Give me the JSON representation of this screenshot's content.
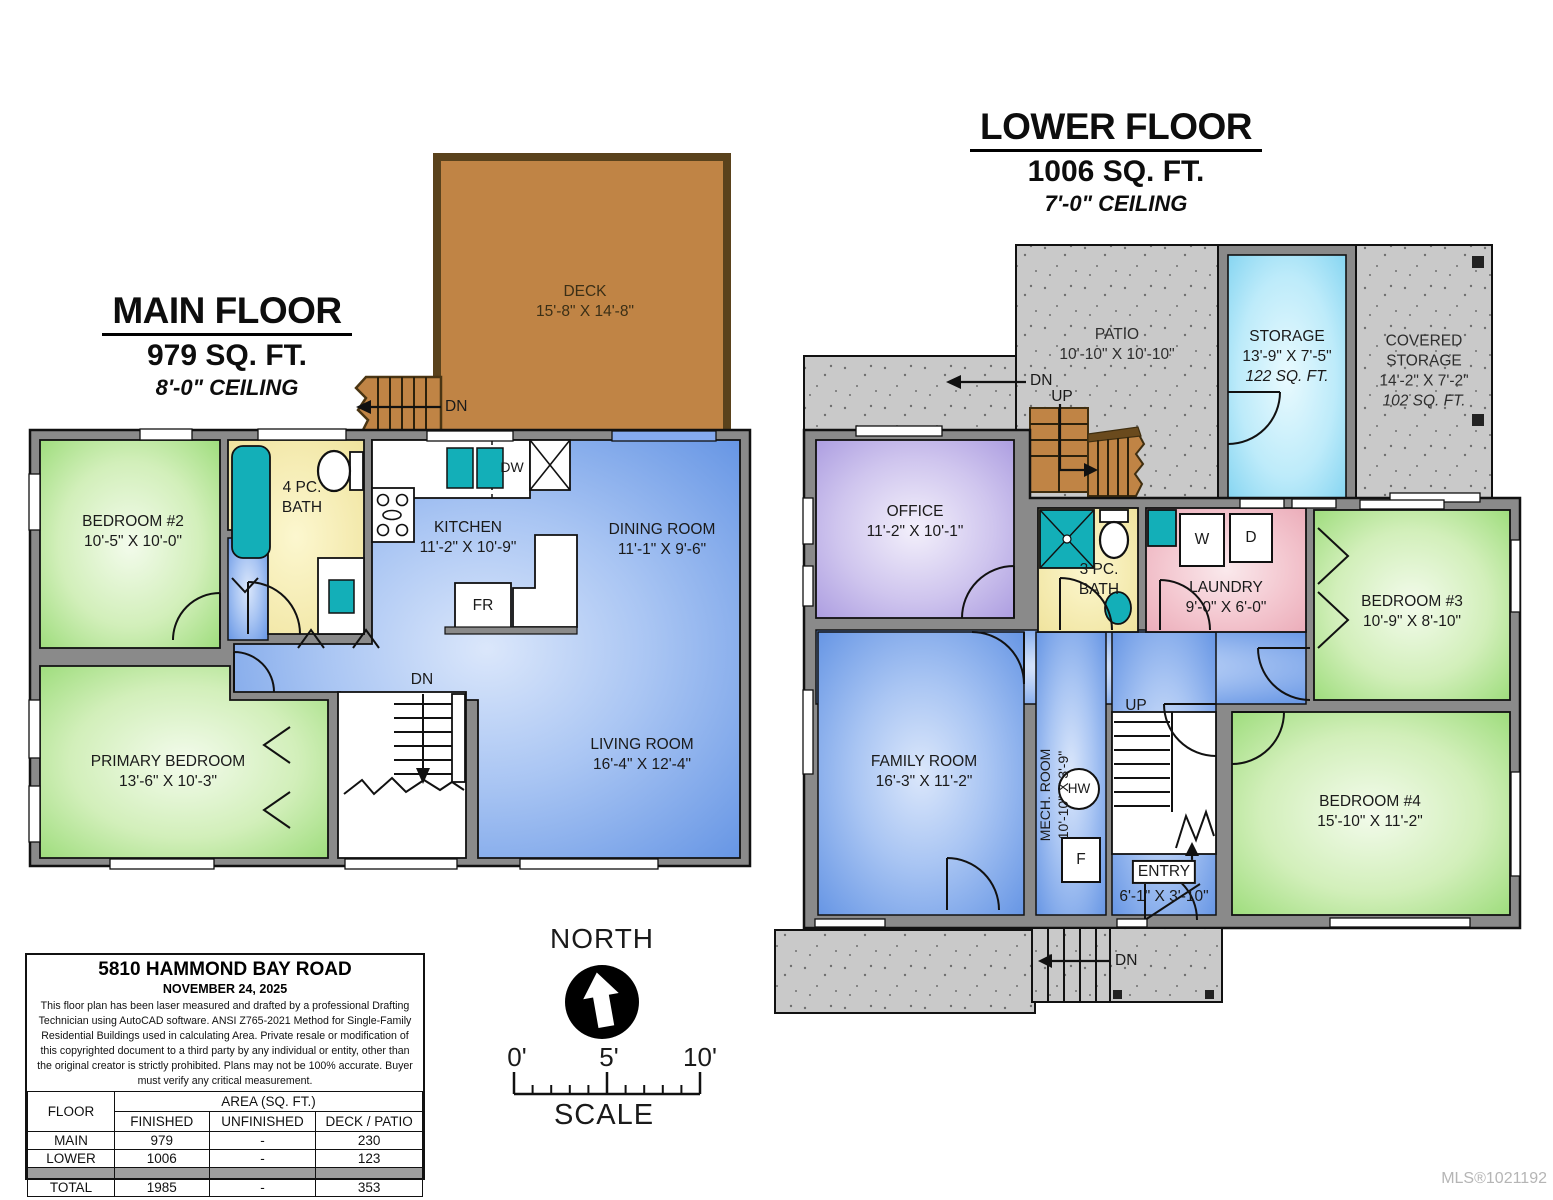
{
  "main_floor": {
    "title": "MAIN FLOOR",
    "area": "979 SQ. FT.",
    "ceiling": "8'-0\" CEILING",
    "deck": {
      "name": "DECK",
      "dims": "15'-8\" X 14'-8\""
    },
    "bedroom2": {
      "name": "BEDROOM #2",
      "dims": "10'-5\" X 10'-0\""
    },
    "bath": {
      "line1": "4 PC.",
      "line2": "BATH"
    },
    "kitchen": {
      "name": "KITCHEN",
      "dims": "11'-2\" X 10'-9\""
    },
    "dining": {
      "name": "DINING ROOM",
      "dims": "11'-1\" X 9'-6\""
    },
    "primary": {
      "name": "PRIMARY BEDROOM",
      "dims": "13'-6\" X 10'-3\""
    },
    "living": {
      "name": "LIVING ROOM",
      "dims": "16'-4\" X 12'-4\""
    },
    "labels": {
      "dn_deck": "DN",
      "dn_stairs": "DN",
      "dw": "DW",
      "fr": "FR"
    }
  },
  "lower_floor": {
    "title": "LOWER FLOOR",
    "area": "1006 SQ. FT.",
    "ceiling": "7'-0\" CEILING",
    "patio": {
      "name": "PATIO",
      "dims": "10'-10\" X 10'-10\""
    },
    "storage": {
      "name": "STORAGE",
      "dims": "13'-9\" X 7'-5\"",
      "sqft": "122 SQ. FT."
    },
    "covered_storage": {
      "name": "COVERED STORAGE",
      "dims": "14'-2\" X 7'-2\"",
      "sqft": "102 SQ. FT."
    },
    "office": {
      "name": "OFFICE",
      "dims": "11'-2\" X 10'-1\""
    },
    "bath": {
      "line1": "3 PC.",
      "line2": "BATH"
    },
    "laundry": {
      "name": "LAUNDRY",
      "dims": "9'-0\" X 6'-0\""
    },
    "bedroom3": {
      "name": "BEDROOM #3",
      "dims": "10'-9\" X 8'-10\""
    },
    "family": {
      "name": "FAMILY ROOM",
      "dims": "16'-3\" X 11'-2\""
    },
    "mech": {
      "name": "MECH. ROOM",
      "dims": "10'-10\" X 3'-9\""
    },
    "entry": {
      "name": "ENTRY",
      "dims": "6'-1\" X 3'-10\""
    },
    "bedroom4": {
      "name": "BEDROOM #4",
      "dims": "15'-10\" X 11'-2\""
    },
    "labels": {
      "dn_patio": "DN",
      "up_patio": "UP",
      "up_stairs": "UP",
      "dn_bottom": "DN",
      "hw": "HW",
      "f": "F",
      "w": "W",
      "d": "D"
    }
  },
  "compass": {
    "north": "NORTH",
    "scale": "SCALE",
    "tick0": "0'",
    "tick5": "5'",
    "tick10": "10'"
  },
  "info_box": {
    "address": "5810 HAMMOND BAY ROAD",
    "date": "NOVEMBER 24, 2025",
    "disclaimer": "This floor plan has been laser measured and drafted by a professional Drafting Technician using AutoCAD software. ANSI Z765-2021 Method for Single-Family Residential Buildings used in calculating Area. Private resale or modification of this copyrighted document to a third party by any individual or entity, other than the original creator is strictly prohibited. Plans may not be 100% accurate.  Buyer must verify any critical measurement.",
    "table": {
      "floor_header": "FLOOR",
      "area_header": "AREA (SQ. FT.)",
      "col_headers": [
        "FINISHED",
        "UNFINISHED",
        "DECK / PATIO"
      ],
      "rows": [
        {
          "floor": "MAIN",
          "finished": "979",
          "unfinished": "-",
          "deck_patio": "230"
        },
        {
          "floor": "LOWER",
          "finished": "1006",
          "unfinished": "-",
          "deck_patio": "123"
        },
        {
          "floor": "TOTAL",
          "finished": "1985",
          "unfinished": "-",
          "deck_patio": "353"
        }
      ]
    }
  },
  "watermark": "MLS®1021192",
  "colors": {
    "wall": "#8a8a8a",
    "room_blue": "#6494e4",
    "room_green": "#9cdc7a",
    "room_purple": "#ab9ce0",
    "room_yellow": "#f1e59c",
    "room_pink": "#eaa9b6",
    "fixture_teal": "#13afb8",
    "deck_brown": "#c08445",
    "concrete": "#c9c9c9",
    "storage_blue": "#7ed2f0"
  }
}
